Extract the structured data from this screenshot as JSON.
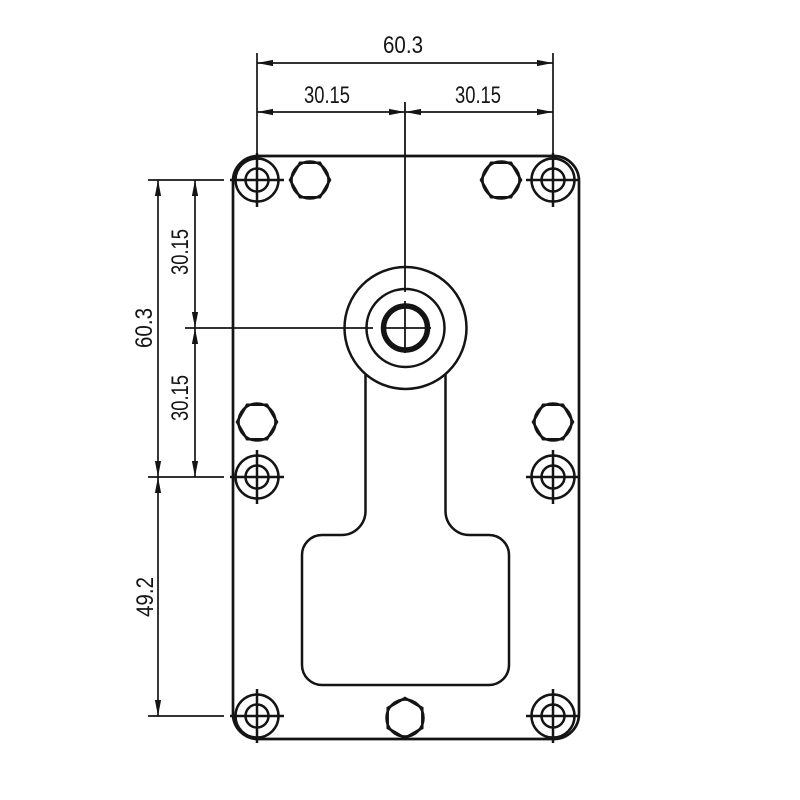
{
  "drawing": {
    "description": "Gearmotor mounting plate front view technical drawing",
    "background": "#ffffff",
    "line_color": "#141414",
    "dimensions": {
      "top_total": "60.3",
      "top_left": "30.15",
      "top_right": "30.15",
      "side_total": "60.3",
      "side_upper": "30.15",
      "side_lower": "30.15",
      "side_bottom": "49.2"
    }
  }
}
